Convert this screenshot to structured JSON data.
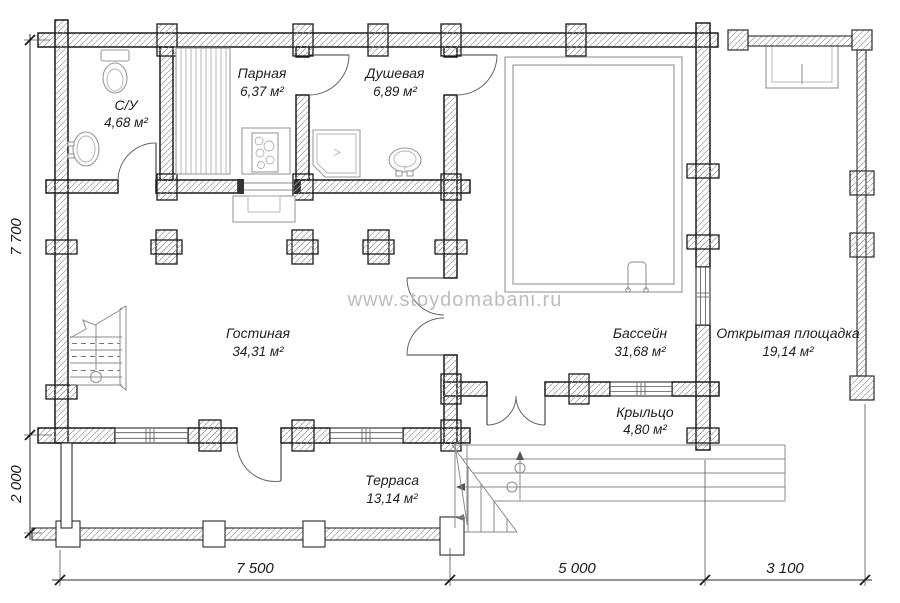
{
  "watermark": "www.stoydomabani.ru",
  "rooms": [
    {
      "id": "bathroom",
      "name": "С/У",
      "area": "4,68 м²"
    },
    {
      "id": "sauna",
      "name": "Парная",
      "area": "6,37 м²"
    },
    {
      "id": "shower",
      "name": "Душевая",
      "area": "6,89 м²"
    },
    {
      "id": "living",
      "name": "Гостиная",
      "area": "34,31 м²"
    },
    {
      "id": "pool",
      "name": "Бассейн",
      "area": "31,68 м²"
    },
    {
      "id": "open-area",
      "name": "Открытая площадка",
      "area": "19,14 м²"
    },
    {
      "id": "porch",
      "name": "Крыльцо",
      "area": "4,80 м²"
    },
    {
      "id": "terrace",
      "name": "Терраса",
      "area": "13,14 м²"
    }
  ],
  "dimensions": {
    "left": [
      "7 700",
      "2 000"
    ],
    "bottom": [
      "7 500",
      "5 000",
      "3 100"
    ]
  },
  "colors": {
    "wall_line": "#1b1b1b",
    "furniture_line": "#9a9a9a",
    "watermark": "#bdbdbd",
    "label_text": "#1f1f1f"
  }
}
